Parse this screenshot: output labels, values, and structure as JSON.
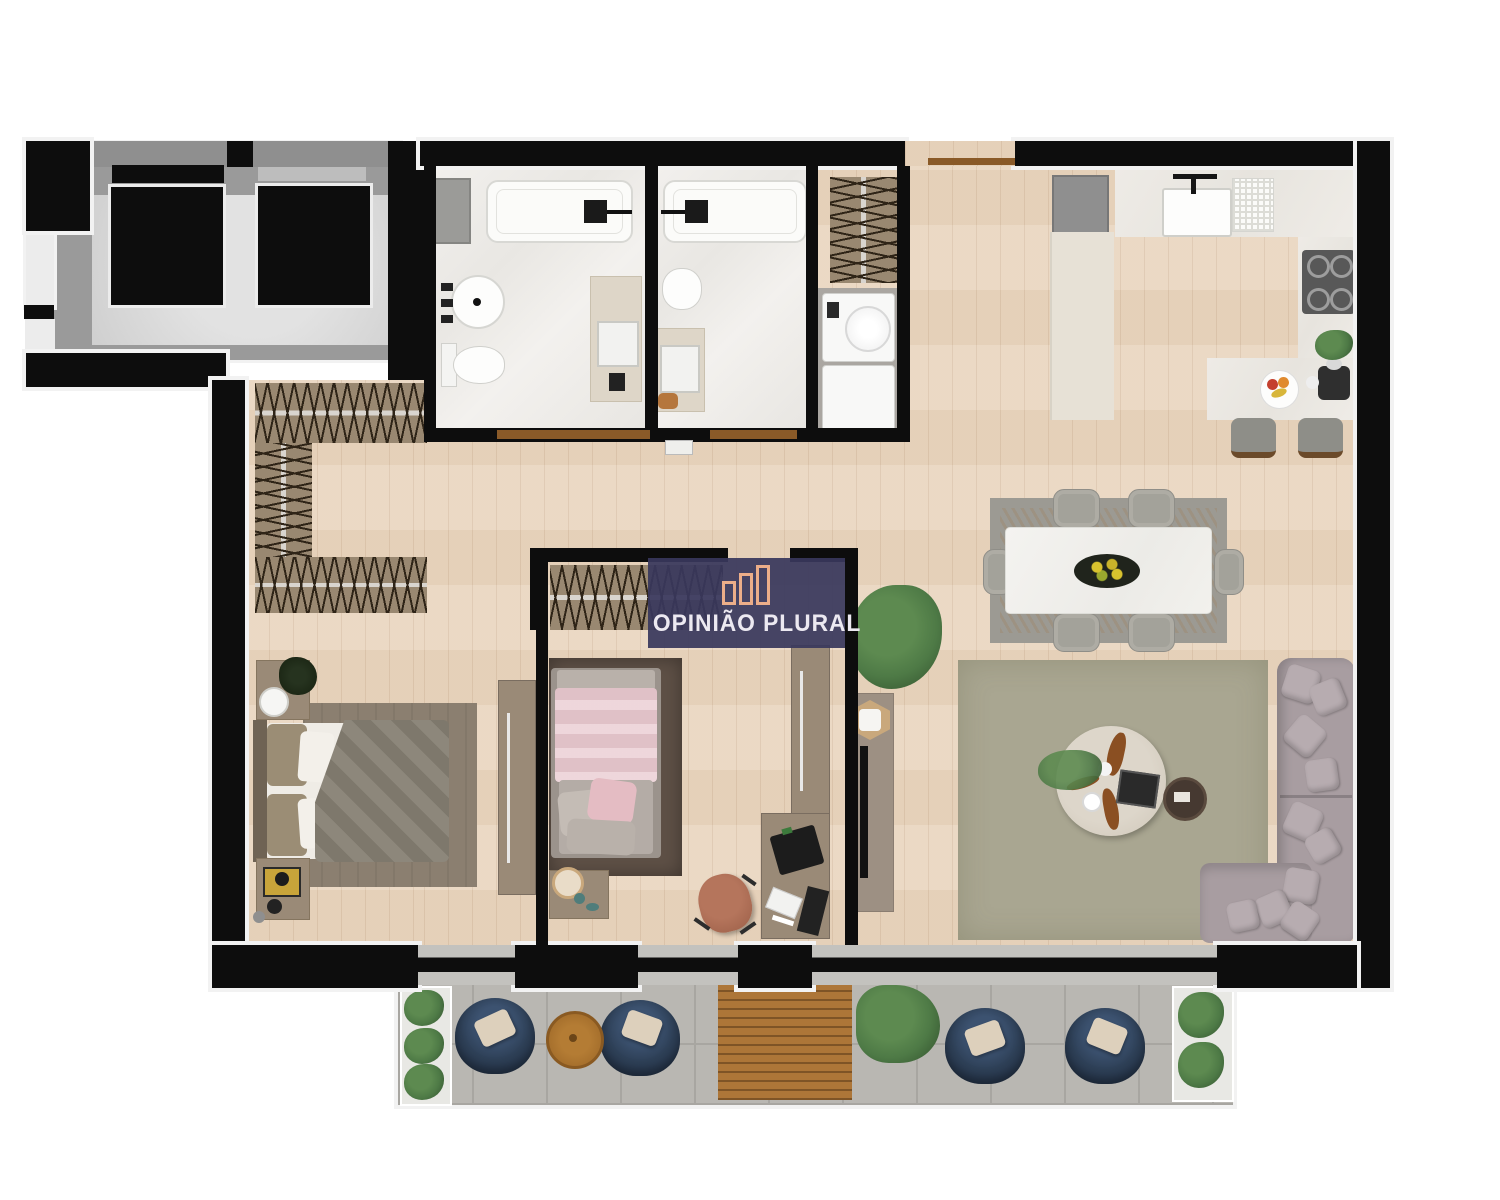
{
  "watermark": {
    "brand": "OPINIÃO PLURAL",
    "logo": "three-bars-chart-logo"
  },
  "palette": {
    "wall": "#0d0d0d",
    "wall_trim": "#f2f2f2",
    "floor_wood": "#ead7c1",
    "marble": "#efede9",
    "balcony_concrete": "#b9b7b2",
    "balcony_line": "#a8a6a1",
    "deck_wood": "#ad7638",
    "closet_wood": "#998871",
    "hatch_line": "#2e2417",
    "furniture_wood": "#9a8a77",
    "rug_living": "#a9a691",
    "rug_dining": "#9c9a93",
    "rug_bed2": "#5e5046",
    "sofa": "#a89da1",
    "pillow": "#b7acb0",
    "armchair_navy": "#2e4057",
    "armchair_pillow": "#ddd0bc",
    "bed1_duvet": "#868073",
    "bed2_pink": "#e9c9cf",
    "elevator_lobby": "#9a9a9a",
    "appliance_white": "#f8f8f7",
    "stove_dark": "#585858",
    "counter_marble": "#ebe8e2",
    "cabinet_beige": "#e7e1d6",
    "watermark_bg": "#3a3960",
    "watermark_text": "#ece9f1",
    "watermark_logo": "#ecae89",
    "plant_green": "#4e7a46",
    "threshold_wood": "#8a5a28",
    "slider_gray": "#c3c2be"
  }
}
